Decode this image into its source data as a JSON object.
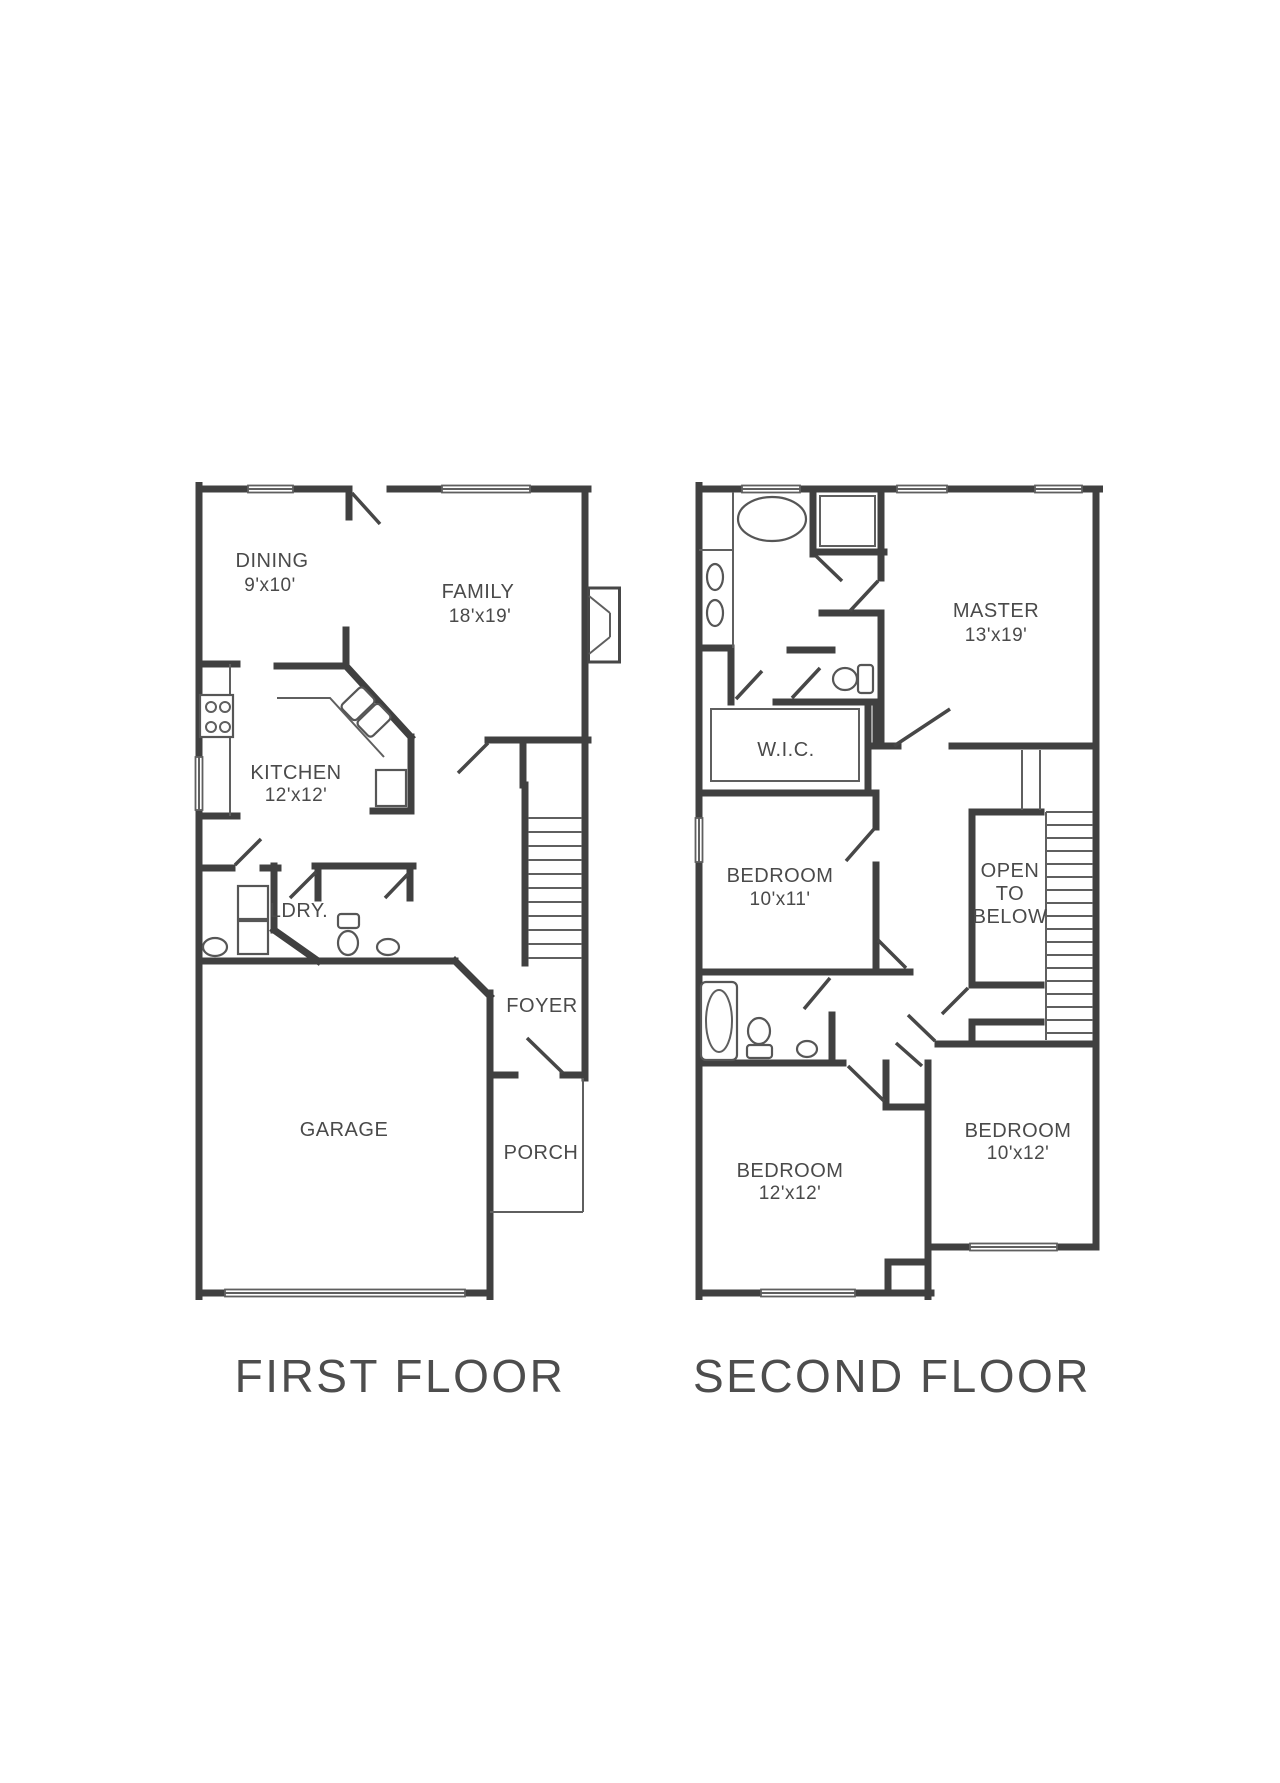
{
  "colors": {
    "wall": "#404040",
    "thin_line": "#5f5f5f",
    "text": "#4a4a4a"
  },
  "first_floor": {
    "title": "FIRST FLOOR",
    "rooms": {
      "dining": {
        "name": "DINING",
        "dims": "9'x10'"
      },
      "family": {
        "name": "FAMILY",
        "dims": "18'x19'"
      },
      "kitchen": {
        "name": "KITCHEN",
        "dims": "12'x12'"
      },
      "laundry": {
        "name": "LDRY."
      },
      "foyer": {
        "name": "FOYER"
      },
      "garage": {
        "name": "GARAGE"
      },
      "porch": {
        "name": "PORCH"
      }
    }
  },
  "second_floor": {
    "title": "SECOND FLOOR",
    "rooms": {
      "master": {
        "name": "MASTER",
        "dims": "13'x19'"
      },
      "wic": {
        "name": "W.I.C."
      },
      "bedroom_10x11": {
        "name": "BEDROOM",
        "dims": "10'x11'"
      },
      "open_to_below": {
        "line1": "OPEN",
        "line2": "TO",
        "line3": "BELOW"
      },
      "bedroom_12x12": {
        "name": "BEDROOM",
        "dims": "12'x12'"
      },
      "bedroom_10x12": {
        "name": "BEDROOM",
        "dims": "10'x12'"
      }
    }
  }
}
